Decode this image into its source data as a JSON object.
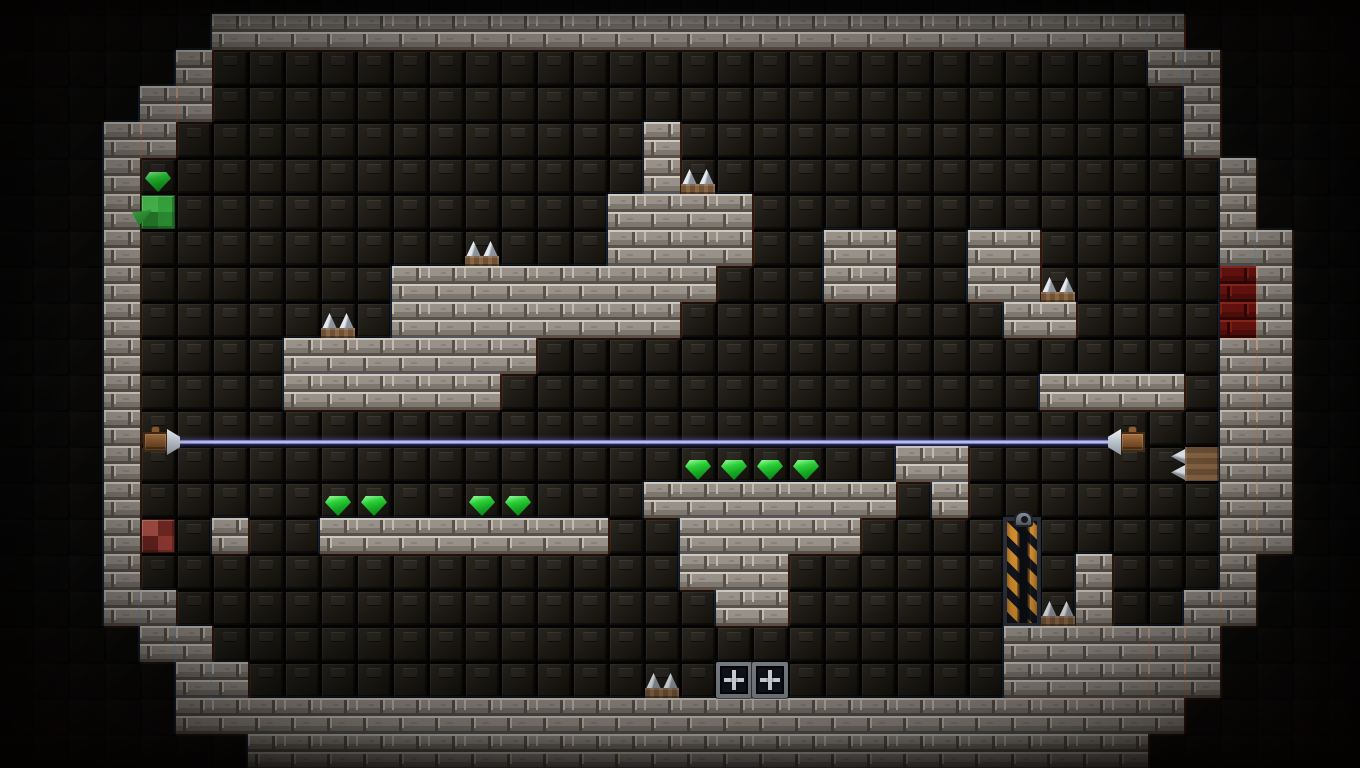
{
  "meta": {
    "scene": "dungeon-room-level",
    "width": 1360,
    "height": 768,
    "tile": 36,
    "offset_x": -4,
    "offset_y": 14,
    "grid_cols": 38,
    "grid_rows": 21,
    "interior_seed": [
      18,
      10
    ]
  },
  "palette": {
    "outside_bg": "#0a0908",
    "grout": "#030303",
    "dark_face_hi": "#2b2720",
    "dark_face": "#1f1c17",
    "dark_face_lo": "#131009",
    "brick_base": "#98918a",
    "brick_light": "#cfc8bc",
    "brick_shade": "#7d776e",
    "brick_seam": "#57514a",
    "brick_edge": "#c2bbb0",
    "door_base": "#6b1310",
    "door_light": "#93291c",
    "door_shade": "#530e0a",
    "door_seam": "#330705",
    "door_edge": "#842015",
    "gem_hi": "#93f795",
    "gem_mid": "#2bd03a",
    "gem_dark": "#0d8a1b",
    "green_tl": "#4ecb55",
    "green_tr": "#3bb843",
    "green_br": "#2f9a36",
    "green_bl": "#27802c",
    "green_border": "#155c1a",
    "red_tl": "#b4544a",
    "red_tr": "#7c2d27",
    "red_br": "#a24038",
    "red_bl": "#6d241f",
    "red_border": "#40100d",
    "spike_light": "#e4e9ef",
    "spike_dark": "#8d939b",
    "dirt": "#8a6644",
    "dirt_dark": "#6b4c31",
    "beam_edge": "#5a5fae",
    "beam_core": "#d8dbff",
    "copper": "#8a5c36",
    "copper_dark": "#432a14",
    "cone_light": "#eef2f6",
    "cone_dark": "#8d959e",
    "stripe_orange": "#cf8c2e",
    "stripe_dark": "#15161b",
    "pillar_frame": "#2b2e36",
    "fan_frame": "#81878e",
    "fan_bg": "#10131c",
    "fan_cross": "#e6ebf0"
  },
  "map": {
    "brick_segments": [
      [
        6,
        0,
        27,
        1
      ],
      [
        32,
        0,
        1,
        2
      ],
      [
        33,
        1,
        1,
        3
      ],
      [
        34,
        4,
        1,
        3
      ],
      [
        35,
        6,
        1,
        9
      ],
      [
        34,
        9,
        1,
        8
      ],
      [
        5,
        1,
        1,
        2
      ],
      [
        4,
        2,
        1,
        2
      ],
      [
        3,
        3,
        1,
        14
      ],
      [
        4,
        16,
        1,
        2
      ],
      [
        5,
        17,
        1,
        2
      ],
      [
        6,
        18,
        1,
        1
      ],
      [
        5,
        19,
        28,
        1
      ],
      [
        7,
        20,
        25,
        1
      ],
      [
        33,
        16,
        1,
        3
      ],
      [
        32,
        17,
        1,
        2
      ],
      [
        18,
        3,
        1,
        2
      ],
      [
        17,
        5,
        4,
        2
      ],
      [
        11,
        7,
        9,
        1
      ],
      [
        11,
        8,
        8,
        1
      ],
      [
        8,
        9,
        7,
        1
      ],
      [
        8,
        10,
        6,
        1
      ],
      [
        23,
        6,
        2,
        2
      ],
      [
        27,
        6,
        2,
        2
      ],
      [
        28,
        8,
        2,
        1
      ],
      [
        25,
        12,
        2,
        1
      ],
      [
        26,
        13,
        1,
        1
      ],
      [
        29,
        10,
        4,
        1
      ],
      [
        9,
        14,
        8,
        1
      ],
      [
        6,
        14,
        1,
        1
      ],
      [
        18,
        13,
        7,
        1
      ],
      [
        19,
        14,
        5,
        1
      ],
      [
        19,
        15,
        3,
        1
      ],
      [
        20,
        16,
        2,
        1
      ],
      [
        28,
        17,
        4,
        2
      ],
      [
        30,
        15,
        1,
        2
      ]
    ],
    "door_segments": [
      [
        34,
        7,
        1,
        2
      ]
    ]
  },
  "items": {
    "gems": [
      [
        4,
        4
      ],
      [
        9,
        13
      ],
      [
        10,
        13
      ],
      [
        13,
        13
      ],
      [
        14,
        13
      ],
      [
        19,
        12
      ],
      [
        20,
        12
      ],
      [
        21,
        12
      ],
      [
        22,
        12
      ]
    ],
    "spikes_up": [
      [
        9,
        8
      ],
      [
        13,
        6
      ],
      [
        19,
        4
      ],
      [
        29,
        7
      ],
      [
        29,
        16
      ],
      [
        18,
        18
      ]
    ],
    "spikes_left": [
      [
        33,
        12
      ]
    ],
    "fans": [
      [
        20,
        18
      ],
      [
        21,
        18
      ]
    ],
    "green_block": [
      4,
      5
    ],
    "green_shard": [
      4,
      5
    ],
    "red_block": [
      4,
      14
    ],
    "pillar": {
      "col": 28,
      "row": 14,
      "height": 3
    },
    "laser": {
      "emitter": [
        4,
        11
      ],
      "receiver": [
        31,
        11
      ],
      "dy": 14
    }
  }
}
